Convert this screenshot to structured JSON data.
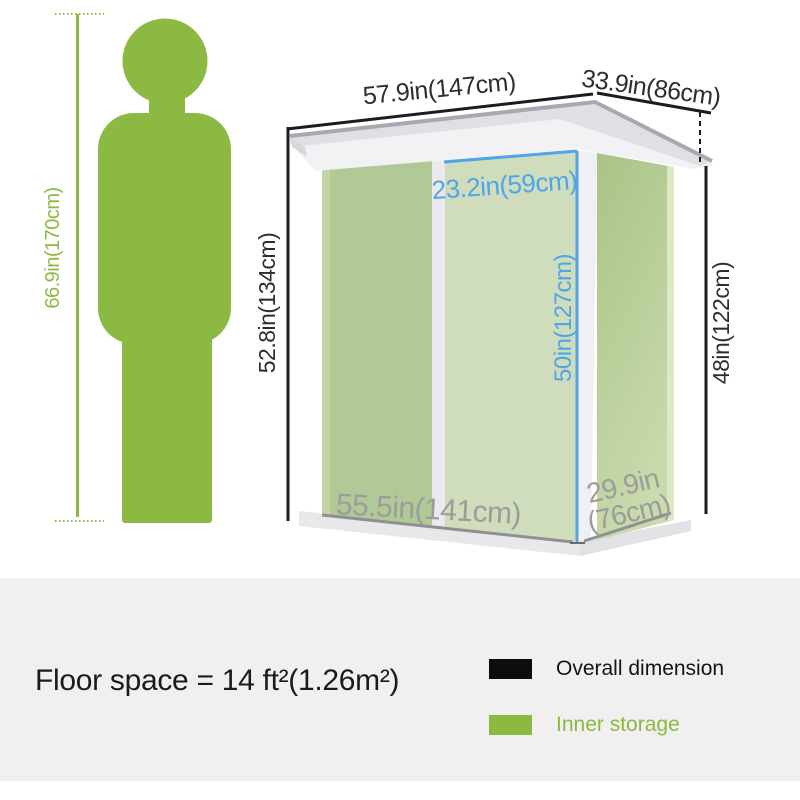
{
  "diagram": {
    "person": {
      "height_label": "66.9in(170cm)"
    },
    "shed": {
      "overall_width_label": "57.9in(147cm)",
      "overall_depth_label": "33.9in(86cm)",
      "front_height_label": "52.8in(134cm)",
      "rear_height_label": "48in(122cm)",
      "door_width_label": "23.2in(59cm)",
      "door_height_label": "50in(127cm)",
      "inner_width_label": "55.5in(141cm)",
      "inner_depth_label_line1": "29.9in",
      "inner_depth_label_line2": "(76cm)"
    }
  },
  "footer": {
    "floor_space": "Floor space = 14 ft²(1.26m²)",
    "legend": [
      {
        "label": "Overall dimension",
        "swatch_color": "#0d0d0d"
      },
      {
        "label": "Inner storage",
        "swatch_color": "#8cb942"
      }
    ]
  },
  "colors": {
    "accent_green": "#8cb942",
    "dimension_blue": "#4fa5e8",
    "dimension_dark": "#2e2e2e",
    "dimension_gray": "#9c9c9c",
    "wall_green": "#b1c997",
    "door_green": "#d0ddbd",
    "roof_gray": "#dfdfe4",
    "panel_background": "#f0f0f0"
  }
}
